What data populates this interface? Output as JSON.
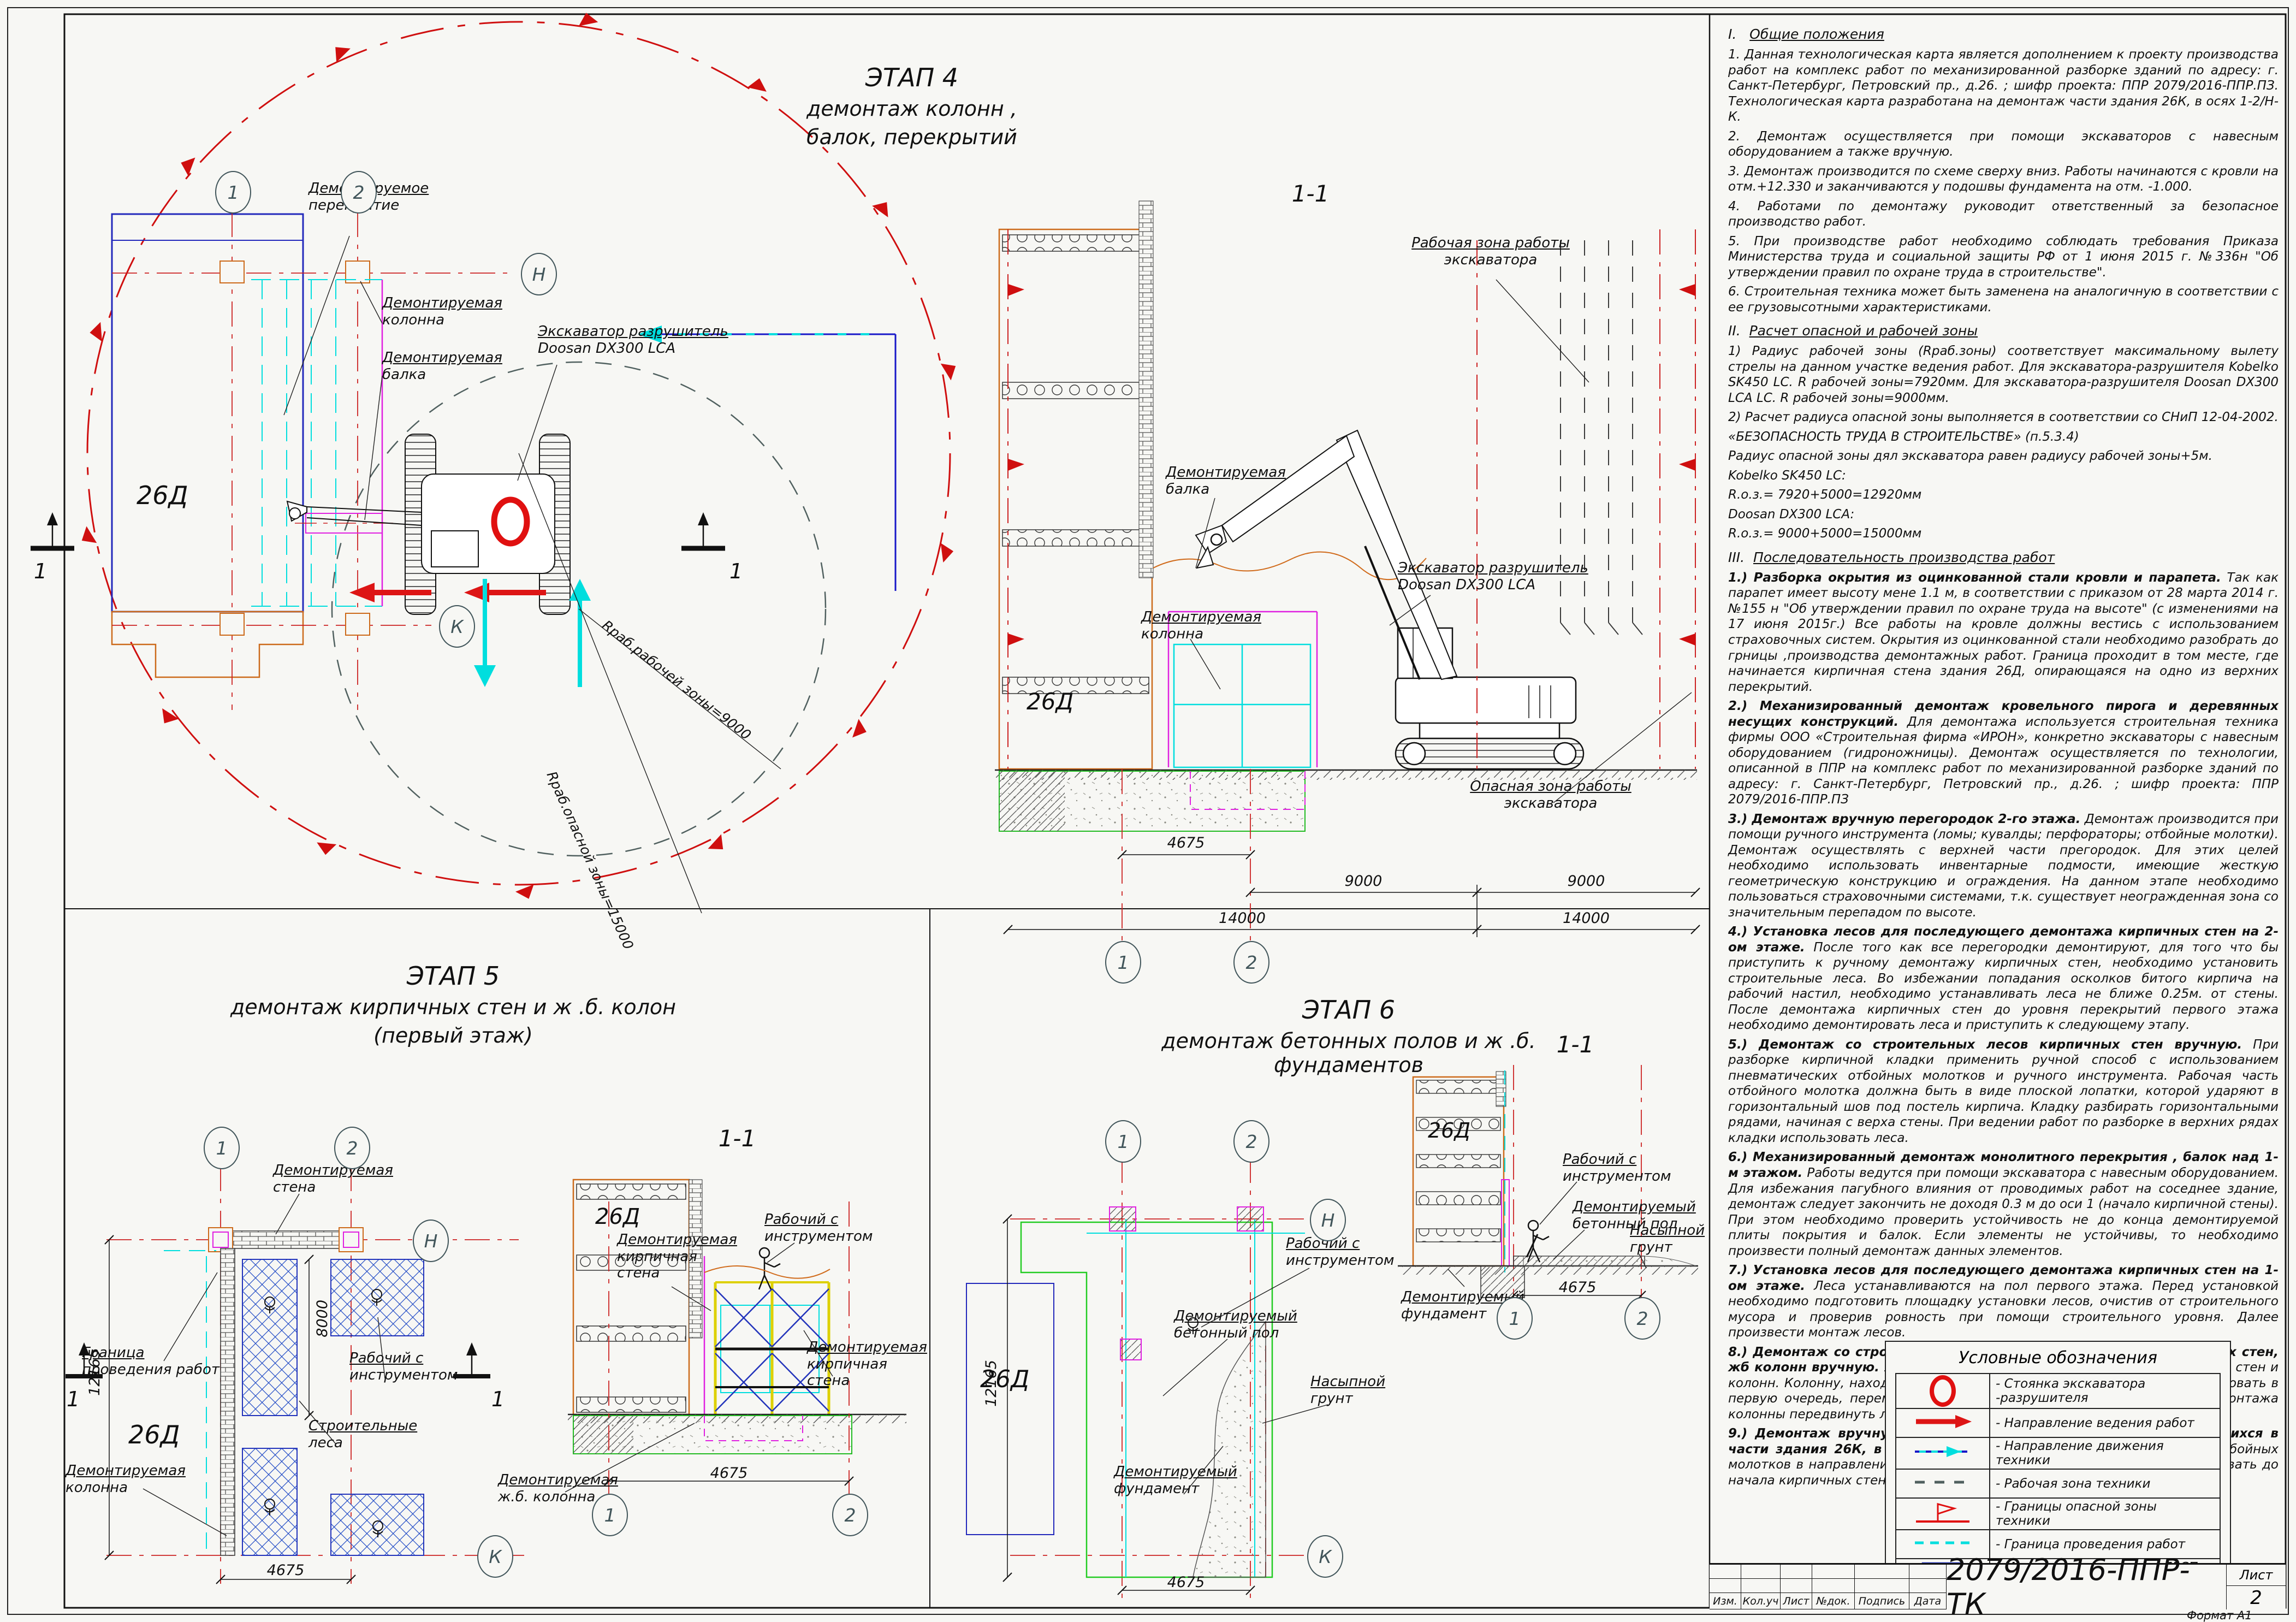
{
  "stage4": {
    "t1": "ЭТАП 4",
    "t2": "демонтаж колонн ,",
    "t3": "балок, перекрытий",
    "slab1": "Демонтируемое",
    "slab2": "перекрытие",
    "col1": "Демонтируемая",
    "col2": "колонна",
    "beam1": "Демонтируемая",
    "beam2": "балка",
    "exc1": "Экскаватор разрушитель",
    "exc2": "Doosan DX300 LCA",
    "rwork": "Rраб.рабочей зоны=9000",
    "rdanger": "Rраб.опасной зоны=15000",
    "bld": "26Д",
    "a1": "1",
    "a2": "2",
    "aN": "Н",
    "aK": "К",
    "sm": "1"
  },
  "sec11": {
    "t": "1-1",
    "wz1": "Рабочая зона работы",
    "wz2": "экскаватора",
    "beam1": "Демонтируемая",
    "beam2": "балка",
    "exc1": "Экскаватор разрушитель",
    "exc2": "Doosan DX300 LCA",
    "dz1": "Опасная зона работы",
    "dz2": "экскаватора",
    "col1": "Демонтируемая",
    "col2": "колонна",
    "bld": "26Д",
    "d4675": "4675",
    "d9000": "9000",
    "d14000": "14000",
    "a1": "1",
    "a2": "2"
  },
  "stage5": {
    "t1": "ЭТАП 5",
    "t2": "демонтаж кирпичных стен и ж .б. колон",
    "t3": "(первый этаж)",
    "wall1": "Демонтируемая",
    "wall2": "стена",
    "border1": "Граница",
    "border2": "проведения работ",
    "worker1": "Рабочий с",
    "worker2": "инструментом",
    "col1": "Демонтируемая",
    "col2": "колонна",
    "lesa1": "Строительные",
    "lesa2": "леса",
    "bld": "26Д",
    "d12165": "12165",
    "d8000": "8000",
    "d4675": "4675",
    "a1": "1",
    "a2": "2",
    "aN": "Н",
    "aK": "К",
    "sm": "1",
    "sec": {
      "t": "1-1",
      "w1": "Рабочий с",
      "w2": "инструментом",
      "bw1": "Демонтируемая",
      "bw2": "кирпичная",
      "bw3": "стена",
      "jb1": "Демонтируемая",
      "jb2": "ж.б. колонна",
      "bld": "26Д",
      "d4675": "4675",
      "a1": "1",
      "a2": "2"
    }
  },
  "stage6": {
    "t1": "ЭТАП 6",
    "t2": "демонтаж бетонных полов и ж .б. фундаментов",
    "worker1": "Рабочий с",
    "worker2": "инструментом",
    "grunt1": "Насыпной",
    "grunt2": "грунт",
    "pol1": "Демонтируемый",
    "pol2": "бетонный пол",
    "fund1": "Демонтируемый",
    "fund2": "фундамент",
    "bld": "26Д",
    "d12165": "12165",
    "d4675": "4675",
    "a1": "1",
    "a2": "2",
    "aN": "Н",
    "aK": "К",
    "sec": {
      "t": "1-1",
      "w1": "Рабочий с",
      "w2": "инструментом",
      "pol1": "Демонтируемый",
      "pol2": "бетонный пол",
      "grunt1": "Насыпной",
      "grunt2": "грунт",
      "fund1": "Демонтируемый",
      "fund2": "фундамент",
      "bld": "26Д",
      "d4675": "4675",
      "a1": "1",
      "a2": "2"
    }
  },
  "notes": {
    "h1n": "I.",
    "h1": "Общие положения",
    "i1": "1. Данная технологическая карта является дополнением к проекту производства работ на комплекс работ по механизированной разборке зданий по адресу: г. Санкт-Петербург, Петровский пр., д.26. ; шифр проекта: ППР 2079/2016-ППР.ПЗ. Технологическая карта разработана на демонтаж части здания 26К, в осях 1-2/Н-К.",
    "i2": "2. Демонтаж осуществляется при помощи экскаваторов с навесным оборудованием а также вручную.",
    "i3": "3. Демонтаж производится по схеме сверху вниз. Работы начинаются с кровли на отм.+12.330  и заканчиваются у подошвы фундамента на отм. -1.000.",
    "i4": "4. Работами по демонтажу руководит ответственный за безопасное производство работ.",
    "i5": "5. При производстве работ необходимо соблюдать требования Приказа Министерства труда и социальной защиты РФ от 1 июня 2015 г. №336н  \"Об утверждении правил по охране труда в строительстве\".",
    "i6": "6. Строительная техника может быть заменена на аналогичную в соответствии с ее грузовысотными характеристиками.",
    "h2n": "II.",
    "h2": "Расчет опасной и рабочей зоны",
    "p21": "1) Радиус рабочей зоны (Rраб.зоны) соответствует максимальному вылету стрелы на данном участке ведения работ. Для экскаватора-разрушителя Kobelko SK450 LC. R рабочей зоны=7920мм. Для экскаватора-разрушителя Doosan DX300 LCA LC.  R рабочей зоны=9000мм.",
    "p22": "2) Расчет радиуса опасной зоны выполняется в соответствии со СНиП 12-04-2002.",
    "p23": "«БЕЗОПАСНОСТЬ ТРУДА В СТРОИТЕЛЬСТВЕ» (п.5.3.4)",
    "p24": "Радиус опасной зоны дял экскаватора равен радиусу рабочей зоны+5м.",
    "p25": "Kobelko SK450 LC:",
    "p26": "R.о.з.= 7920+5000=12920мм",
    "p27": "Doosan DX300 LCA:",
    "p28": "R.о.з.= 9000+5000=15000мм",
    "h3n": "III.",
    "h3": "Последовательность производства работ",
    "s3": [
      {
        "h": "1.) Разборка окрытия  из оцинкованной стали кровли и парапета.",
        "b": "Так как парапет имеет высоту мене 1.1 м, в соответствии с приказом от 28 марта 2014 г.  №155 н \"Об утверждении правил по охране труда на высоте\" (с изменениями на 17 июня 2015г.) Все работы на кровле должны вестись с использованием страховочных систем. Окрытия  из оцинкованной стали необходимо разобрать до грницы ,производства демонтажных работ. Граница проходит в том месте, где начинается кирпичная стена здания 26Д, опирающаяся на одно из верхних перекрытий."
      },
      {
        "h": "2.) Механизированный демонтаж  кровельного пирога и деревянных несущих  конструкций.",
        "b": "Для демонтажа используется строительная техника фирмы ООО «Строительная фирма «ИРОН», конкретно экскаваторы с навесным оборудованием (гидроножницы). Демонтаж осуществляется по технологии, описанной в ППР на комплекс работ по механизированной разборке зданий по адресу: г. Санкт-Петербург, Петровский пр., д.26. ; шифр проекта: ППР 2079/2016-ППР.ПЗ"
      },
      {
        "h": "3.) Демонтаж вручную перегородок 2-го этажа.",
        "b": "Демонтаж производится при помощи ручного инструмента (ломы; кувалды; перфораторы; отбойные молотки). Демонтаж осуществлять с верхней части прегородок. Для этих целей необходимо использовать инвентарные подмости, имеющие жесткую геометрическую конструкцию и ограждения. На данном этапе необходимо пользоваться страховочными системами, т.к. существует неогражденная зона со значительным перепадом по высоте."
      },
      {
        "h": "4.) Установка лесов для последующего демонтажа кирпичных стен на 2-ом     этаже.",
        "b": "После того как все перегородки демонтируют, для того что бы приступить к ручному демонтажу кирпичных стен, необходимо установить строительные леса. Во избежании попадания осколков битого кирпича на рабочий настил, необходимо устанавливать леса не ближе 0.25м. от стены. После демонтажа кирпичных стен до уровня перекрытий первого этажа необходимо демонтировать леса и приступить к следующему этапу."
      },
      {
        "h": "5.) Демонтаж со строительных лесов кирпичных стен вручную.",
        "b": "При разборке кирпичной кладки применить ручной способ с использованием пневматических отбойных молотков и ручного инструмента. Рабочая часть отбойного молотка должна быть в виде плоской лопатки, которой ударяют в горизонтальный шов под постель кирпича. Кладку разбирать горизонтальными рядами, начиная с верха стены. При ведении работ по разборке в верхних рядах кладки использовать леса."
      },
      {
        "h": "6.) Механизированный демонтаж монолитного перекрытия , балок над 1-м этажом.",
        "b": "Работы ведутся при помощи экскаватора с навесным оборудованием. Для избежания пагубного влияния от проводимых работ на соседнее здание, демонтаж следует закончить не доходя 0.3 м до оси 1 (начало кирпичной стены). При этом необходимо проверить устойчивость не до конца демонтируемой плиты покрытия и балок. Если элементы не устойчивы, то необходимо произвести полный демонтаж данных элементов."
      },
      {
        "h": "7.) Установка лесов для последующего демонтажа кирпичных стен на 1-ом этаже.",
        "b": "Леса устанавливаются на пол первого этажа. Перед установкой необходимо подготовить площадку установки лесов, очистив от строительного мусора и проверив ровность при помощи строительного уровня. Далее произвести монтаж лесов."
      },
      {
        "h": "8.) Демонтаж со строительных лесов оставшихся частей кирпичных стен, жб колонн вручную.",
        "b": "Установить леса согласно схеме. Начать демонтаж стен и колонн. Колонну, находящуюся внутри помещения необходимо демонтировать в первую очередь, перемещаясь по рядам лесов сверху вниз.  После демонтажа колонны передвинуть леса и продолжить демонтаж кирпичных стен."
      },
      {
        "h": "9.) Демонтаж вручную бетонных полов и фундаментов, находящихся в части здания 26К, в осях 1-2/Н-К",
        "b": "Демонтаж ведется при помощи отбойных молотков  в направлении здания 26Д. Фундамент необходимо демонтировать до начала кирпичных стен, здания 26Д, которые на него опираются."
      }
    ]
  },
  "legend": {
    "title": "Условные обозначения",
    "r1": "- Стоянка экскаватора -разрушителя",
    "r2": "- Направление ведения работ",
    "r3": "- Направление движения техники",
    "r4": "- Рабочая зона техники",
    "r5": "- Границы опасной зоны техники",
    "r6": "- Граница проведения работ",
    "r7": "- Места установки лесов ЛРСП -100"
  },
  "titleblock": {
    "code": "2079/2016-ППР-ТК",
    "sheet_label": "Лист",
    "sheet_no": "2",
    "format": "Формат А1",
    "c1": "Изм.",
    "c2": "Кол.уч",
    "c3": "Лист",
    "c4": "№док.",
    "c5": "Подпись",
    "c6": "Дата"
  }
}
